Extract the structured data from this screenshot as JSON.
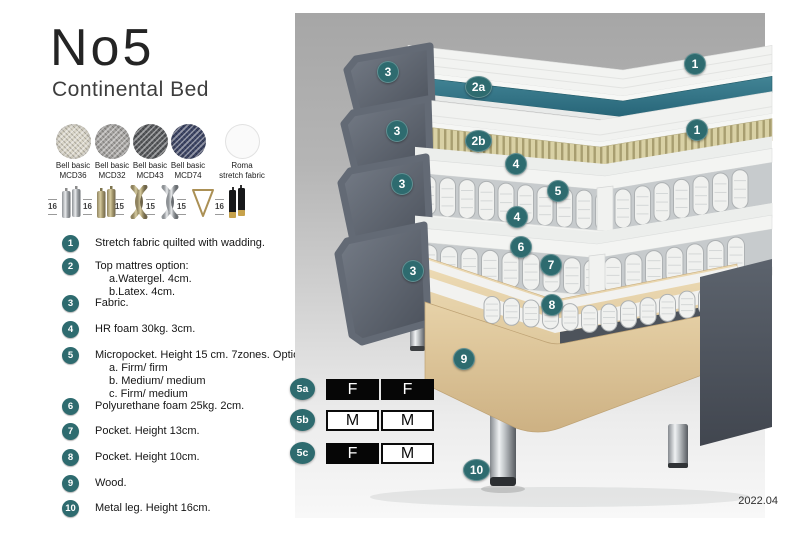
{
  "header": {
    "title": "No5",
    "subtitle": "Continental Bed"
  },
  "fabrics": [
    {
      "line1": "Bell basic",
      "line2": "MCD36"
    },
    {
      "line1": "Bell basic",
      "line2": "MCD32"
    },
    {
      "line1": "Bell basic",
      "line2": "MCD43"
    },
    {
      "line1": "Bell basic",
      "line2": "MCD74"
    },
    {
      "line1": "Roma",
      "line2": "stretch fabric"
    }
  ],
  "leg_options": [
    {
      "height": "16",
      "style": "cylinder-silver"
    },
    {
      "height": "16",
      "style": "cylinder-brass"
    },
    {
      "height": "15",
      "style": "twisted-gold"
    },
    {
      "height": "15",
      "style": "twisted-silver"
    },
    {
      "height": "15",
      "style": "hairpin"
    },
    {
      "height": "16",
      "style": "cylinder-black-gold"
    }
  ],
  "legend": [
    {
      "num": "1",
      "text": "Stretch fabric quilted with wadding.",
      "sub": []
    },
    {
      "num": "2",
      "text": "Top mattres option:",
      "sub": [
        "a.Watergel. 4cm.",
        "b.Latex. 4cm."
      ]
    },
    {
      "num": "3",
      "text": "Fabric.",
      "sub": []
    },
    {
      "num": "4",
      "text": "HR foam 30kg. 3cm.",
      "sub": []
    },
    {
      "num": "5",
      "text": "Micropocket. Height 15 cm. 7zones. Option:",
      "sub": [
        "a. Firm/ firm",
        "b. Medium/ medium",
        "c. Firm/ medium"
      ]
    },
    {
      "num": "6",
      "text": "Polyurethane foam 25kg. 2cm.",
      "sub": []
    },
    {
      "num": "7",
      "text": "Pocket. Height 13cm.",
      "sub": []
    },
    {
      "num": "8",
      "text": "Pocket. Height 10cm.",
      "sub": []
    },
    {
      "num": "9",
      "text": "Wood.",
      "sub": []
    },
    {
      "num": "10",
      "text": "Metal leg. Height 16cm.",
      "sub": []
    }
  ],
  "dimensions": [
    "6",
    "6",
    "21 cm",
    "27 cm",
    "16 cm"
  ],
  "badges": {
    "n1": "1",
    "n2a": "2a",
    "n2b": "2b",
    "n3": "3",
    "n4": "4",
    "n5": "5",
    "n6": "6",
    "n7": "7",
    "n8": "8",
    "n9": "9",
    "n10": "10"
  },
  "firmness": {
    "rows": [
      {
        "label": "5a",
        "cells": [
          {
            "text": "F",
            "tone": "dark"
          },
          {
            "text": "F",
            "tone": "dark"
          }
        ]
      },
      {
        "label": "5b",
        "cells": [
          {
            "text": "M",
            "tone": "light"
          },
          {
            "text": "M",
            "tone": "light"
          }
        ]
      },
      {
        "label": "5c",
        "cells": [
          {
            "text": "F",
            "tone": "dark"
          },
          {
            "text": "M",
            "tone": "light"
          }
        ]
      }
    ]
  },
  "footer": {
    "version": "2022.04"
  },
  "colors": {
    "badge_teal": "#2e6b6f",
    "watergel_teal": "#35798a",
    "side_gray": "#5d6470",
    "latex_tan": "#d9d1a5",
    "wood": "#e3c99c"
  }
}
